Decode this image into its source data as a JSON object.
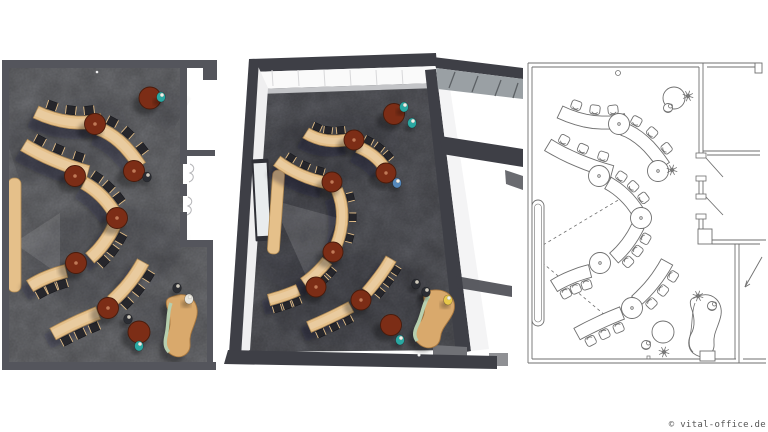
{
  "footer": {
    "copyright": "© vital-office.de"
  },
  "colors": {
    "background": "#ffffff",
    "wall_dark": "#54555c",
    "wall_mid_dark": "#3e3f46",
    "floor_gray": "#6e6f73",
    "floor_mid": "#5b5c62",
    "table_wood": "#e5c08a",
    "table_wood_edge": "#b38c55",
    "chair_dark": "#26262b",
    "round_table_brown": "#7c2d16",
    "round_table_rim": "#4a1b0b",
    "round_table_dot": "#c07a58",
    "desk_wood": "#d9a96c",
    "desk_accent_green": "#b7cfae",
    "person_teal": "#2aa8a2",
    "person_blue": "#5588bb",
    "person_yellow": "#e8c84a",
    "person_dark": "#2b2d33",
    "person_light": "#e8e6df",
    "glazing_gray": "#9aa0a4",
    "line_art": "#6f6f6f",
    "line_faint": "#b5b5b8"
  }
}
